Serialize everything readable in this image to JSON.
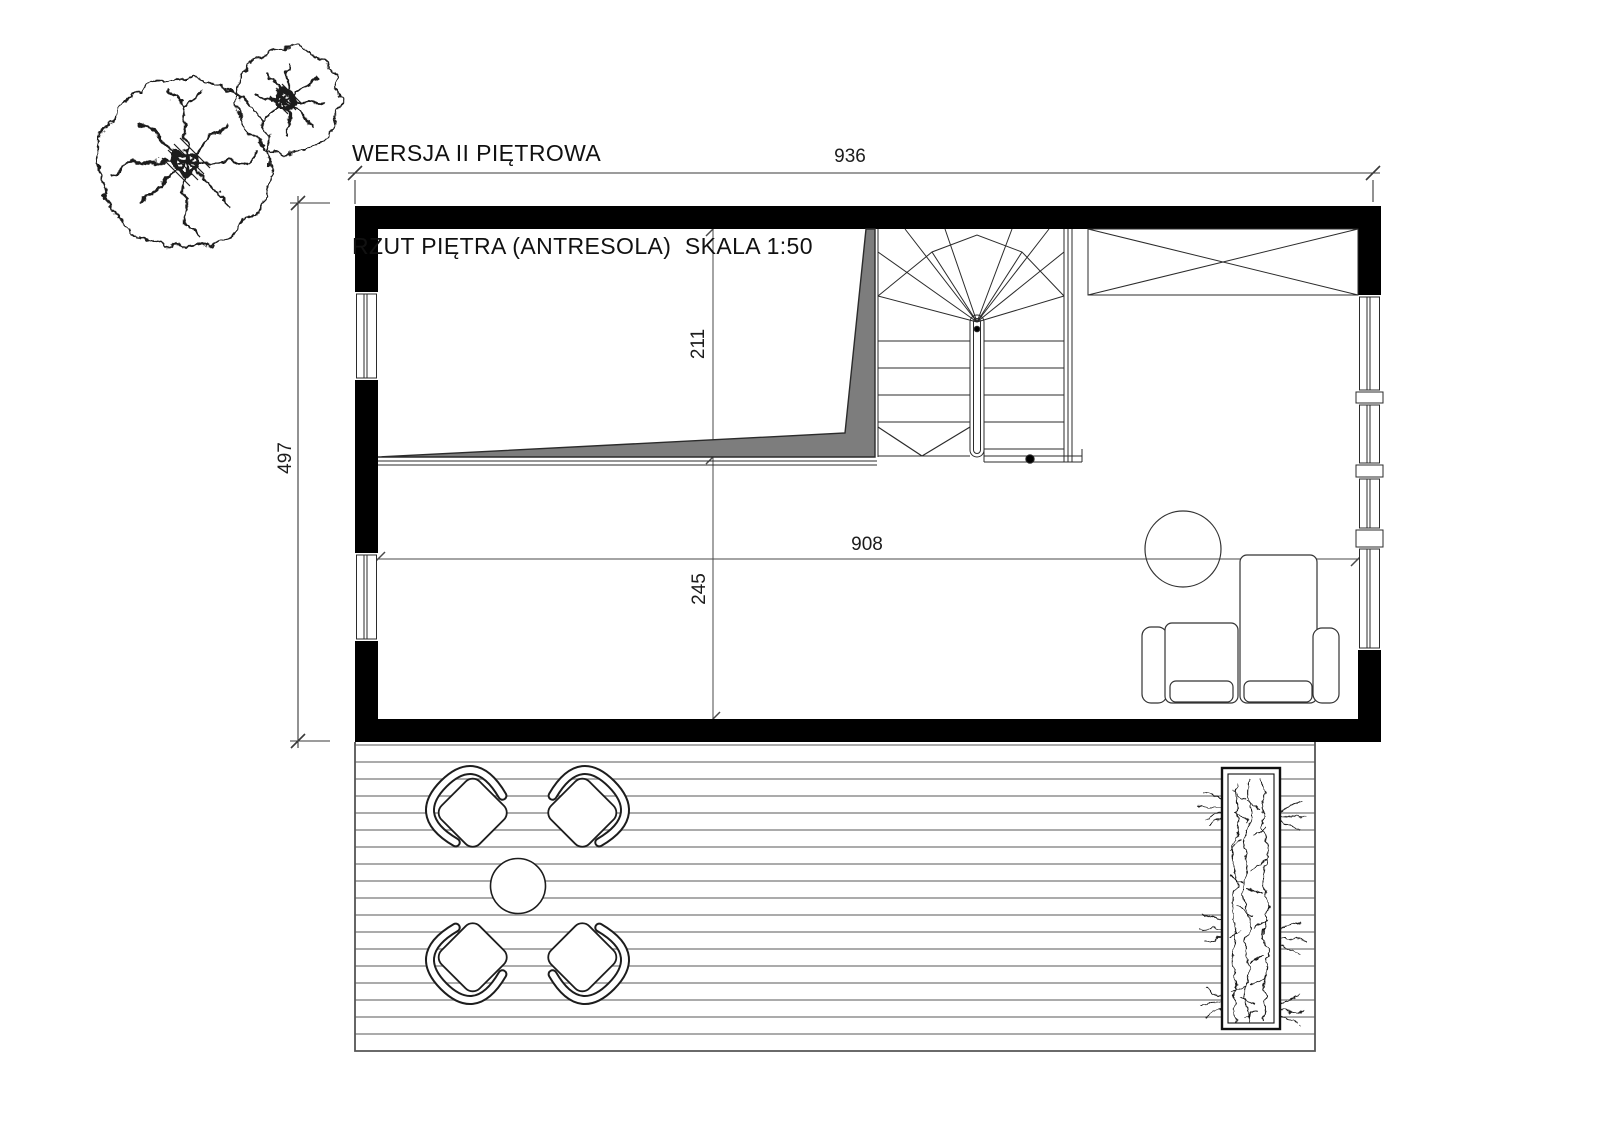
{
  "title": {
    "line1": "WERSJA II PIĘTROWA",
    "line2": "RZUT PIĘTRA (ANTRESOLA)  SKALA 1:50"
  },
  "dimensions": {
    "building_width": "936",
    "building_depth": "497",
    "mezzanine_depth": "211",
    "lower_zone_depth": "245",
    "interior_width": "908"
  },
  "colors": {
    "walls": "#000000",
    "mezzanine_fill": "#7d7d7d",
    "linework": "#2b2b2b",
    "deck_lines": "#8f8f8f",
    "background": "#ffffff"
  }
}
